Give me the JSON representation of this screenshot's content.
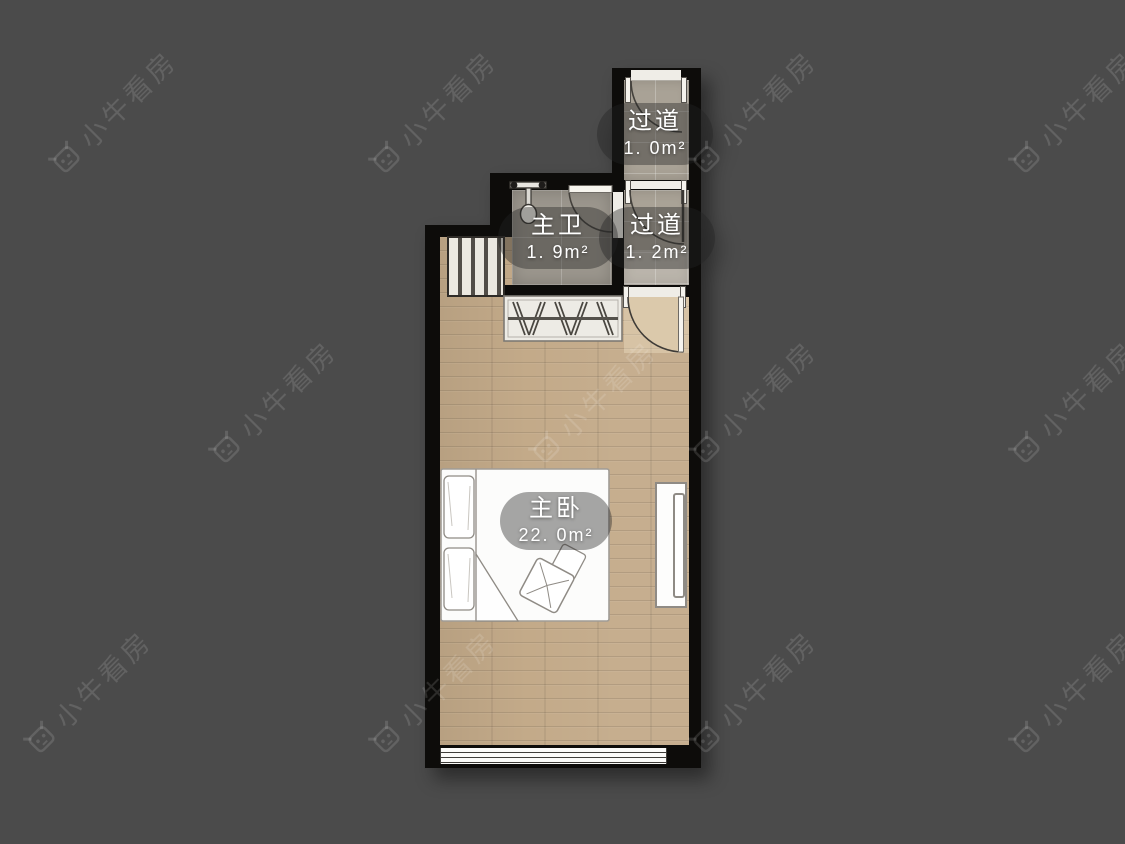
{
  "watermark": {
    "text": "小牛看房"
  },
  "floorplan": {
    "rooms": [
      {
        "key": "hallway_top",
        "name": "过道",
        "area": "1. 0m²"
      },
      {
        "key": "master_bathroom",
        "name": "主卫",
        "area": "1. 9m²"
      },
      {
        "key": "hallway_mid",
        "name": "过道",
        "area": "1. 2m²"
      },
      {
        "key": "master_bedroom",
        "name": "主卧",
        "area": "22. 0m²"
      }
    ],
    "colors": {
      "background": "#4b4b4b",
      "wall": "#0d0c0a",
      "wood_floor": "#c3aa89",
      "bath_tile": "#9b968d",
      "hall_tile": "#a9a296",
      "label_background": "rgba(35,35,35,0.40)",
      "label_text": "#ffffff"
    }
  }
}
